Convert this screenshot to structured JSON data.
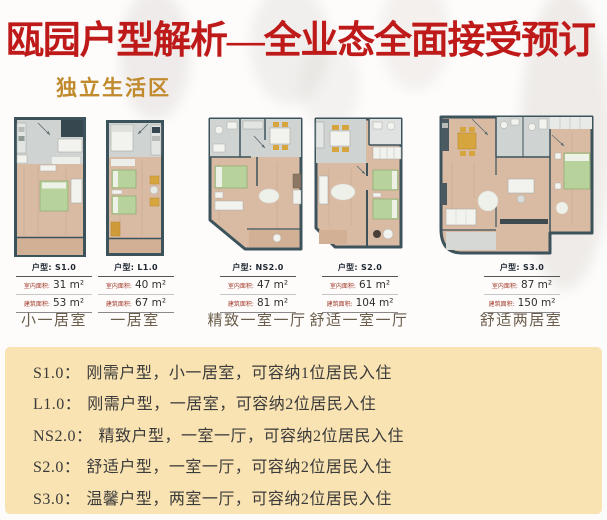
{
  "header": {
    "title": "瓯园户型解析—全业态全面接受预订",
    "subtitle": "独立生活区",
    "title_color": "#bf1a1a",
    "subtitle_color": "#c08a2d"
  },
  "labels": {
    "type": "户型:",
    "indoor": "室内面积:",
    "gross": "建筑面积:"
  },
  "plans": [
    {
      "id": "S1.0",
      "name": "小一居室",
      "indoor_area": "31 m²",
      "gross_area": "53 m²"
    },
    {
      "id": "L1.0",
      "name": "一居室",
      "indoor_area": "40 m²",
      "gross_area": "67 m²"
    },
    {
      "id": "NS2.0",
      "name": "精致一室一厅",
      "indoor_area": "47 m²",
      "gross_area": "81 m²"
    },
    {
      "id": "S2.0",
      "name": "舒适一室一厅",
      "indoor_area": "61 m²",
      "gross_area": "104 m²"
    },
    {
      "id": "S3.0",
      "name": "舒适两居室",
      "indoor_area": "87 m²",
      "gross_area": "150 m²"
    }
  ],
  "legend": {
    "bg_color": "#f9e3b2",
    "items": [
      {
        "code": "S1.0：",
        "desc": "刚需户型，小一居室，可容纳1位居民入住"
      },
      {
        "code": "L1.0：",
        "desc": "刚需户型，一居室，可容纳2位居民入住"
      },
      {
        "code": "NS2.0：",
        "desc": "精致户型，一室一厅，可容纳2位居民入住"
      },
      {
        "code": "S2.0：",
        "desc": "舒适户型，一室一厅，可容纳2位居民入住"
      },
      {
        "code": "S3.0：",
        "desc": "温馨户型，两室一厅，可容纳2位居民入住"
      }
    ]
  },
  "palette": {
    "wall": "#3d535c",
    "wood_floor": "#d9bba4",
    "tile": "#cfd3d1",
    "bed_green": "#b7d29a",
    "accent_yellow": "#d7a53e"
  }
}
